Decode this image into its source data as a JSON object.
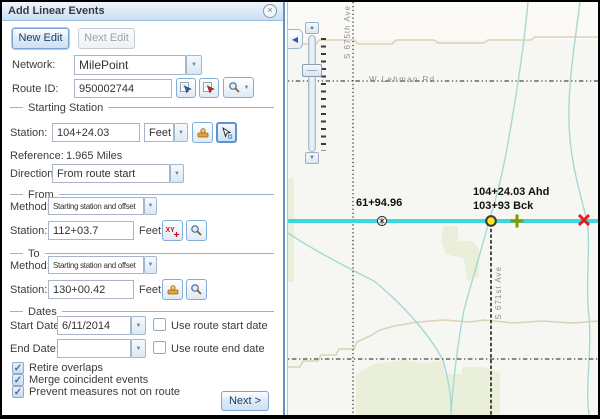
{
  "icons": {
    "close": "×",
    "dropdown": "▼",
    "up": "▲",
    "down": "▼",
    "collapse": "◀",
    "check": "✓",
    "xy": "XY"
  },
  "panel": {
    "title": "Add Linear Events",
    "new_edit": "New Edit",
    "next_edit": "Next Edit",
    "network_label": "Network:",
    "network_value": "MilePoint",
    "route_id_label": "Route ID:",
    "route_id_value": "950002744",
    "starting_station": {
      "legend": "Starting Station",
      "station_label": "Station:",
      "station_value": "104+24.03",
      "units": "Feet",
      "reference_label": "Reference:",
      "reference_value": "1.965 Miles",
      "direction_label": "Direction:",
      "direction_value": "From route start"
    },
    "from": {
      "legend": "From",
      "method_label": "Method:",
      "method_value": "Starting station and offset",
      "station_label": "Station:",
      "station_value": "112+03.7",
      "units": "Feet"
    },
    "to": {
      "legend": "To",
      "method_label": "Method:",
      "method_value": "Starting station and offset",
      "station_label": "Station:",
      "station_value": "130+00.42",
      "units": "Feet"
    },
    "dates": {
      "legend": "Dates",
      "start_label": "Start Date:",
      "start_value": "6/11/2014",
      "end_label": "End Date:",
      "end_value": "",
      "use_start": "Use route start date",
      "use_end": "Use route end date"
    },
    "options": [
      {
        "label": "Retire overlaps",
        "checked": true
      },
      {
        "label": "Merge coincident events",
        "checked": true
      },
      {
        "label": "Prevent measures not on route",
        "checked": true
      }
    ],
    "next_button": "Next >"
  },
  "map": {
    "road_labels": {
      "s675": "S 675th Ave",
      "lehman": "W Lehman Rd",
      "s671": "S 671st Ave"
    },
    "measure_labels": {
      "left_point": "61+94.96",
      "ahead": "104+24.03 Ahd",
      "back": "103+93 Bck"
    },
    "colors": {
      "route": "#3BD8E2",
      "point_yellow": "#FFE81A",
      "point_green": "#7E9B00",
      "point_red": "#E51A1A",
      "stream": "#A6D8D4",
      "contour": "#DCD2BA",
      "land": "#E9EFD9"
    }
  }
}
